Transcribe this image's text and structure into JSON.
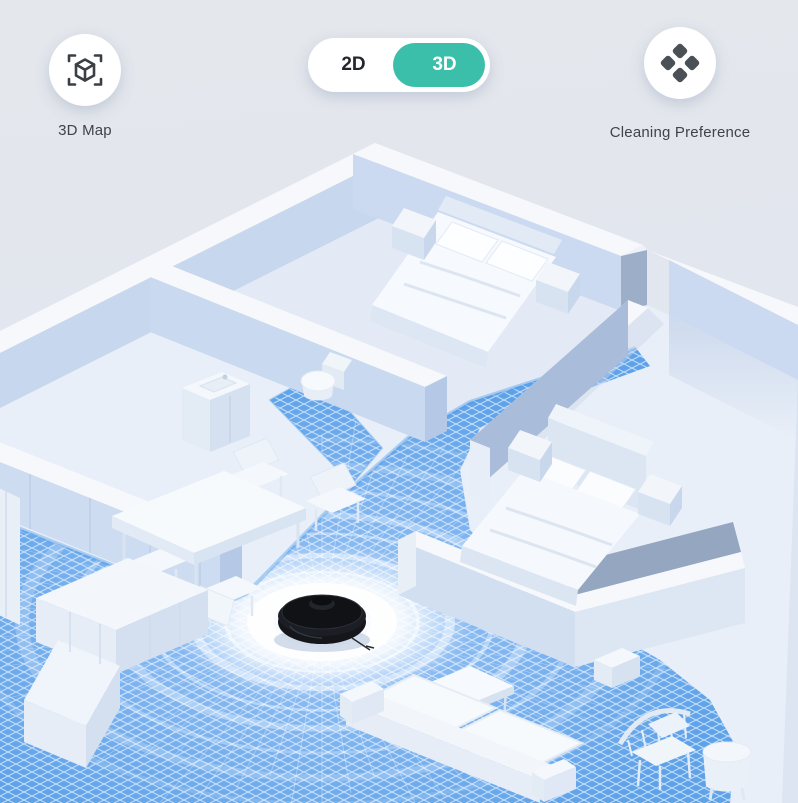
{
  "toolbar": {
    "map_button": {
      "label": "3D Map",
      "icon": "cube-scan-icon"
    },
    "view_toggle": {
      "option_2d": "2D",
      "option_3d": "3D",
      "selected": "3D",
      "active_color": "#3BBFAB",
      "inactive_text_color": "#23262B"
    },
    "preference_button": {
      "label": "Cleaning Preference",
      "icon": "four-diamonds-icon"
    }
  },
  "scene": {
    "robot": {
      "name": "robot-vacuum",
      "body_color": "#15171C"
    },
    "scan": {
      "grid_color": "#7FB5F0",
      "edge_color": "#4E9BE9",
      "ring_color": "#FFFFFF"
    },
    "walls": {
      "top": "#F5F8FC",
      "face_light": "#C9D9F0",
      "face_shadow": "#93A5C0"
    },
    "floor": {
      "base": "#E9EFF8",
      "bedroom": "#E3EAF5"
    },
    "furniture": [
      "bed",
      "bed",
      "nightstand",
      "nightstand",
      "nightstand",
      "nightstand",
      "dining-table",
      "dining-chair",
      "dining-chair",
      "dining-chair",
      "dining-chair",
      "sofa",
      "coffee-table",
      "kitchen-counter",
      "kitchen-island",
      "cabinet",
      "toilet",
      "bathroom-vanity",
      "tv-cabinet",
      "armchair",
      "side-stool"
    ]
  }
}
